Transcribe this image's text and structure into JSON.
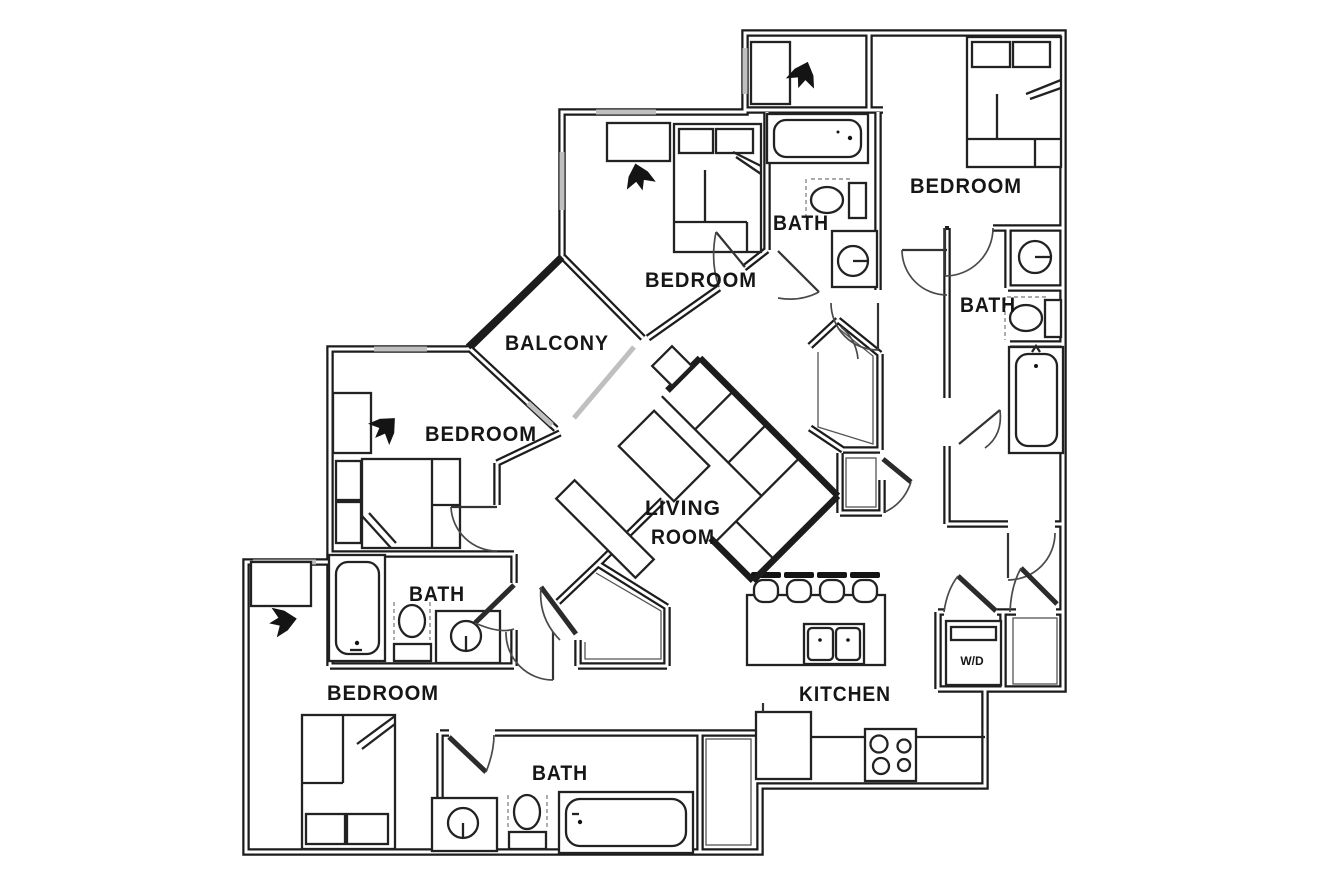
{
  "plan": {
    "colors": {
      "line": "#1c1c1c",
      "window": "#bfbfbf",
      "door_arc": "#4a4a4a"
    },
    "labels": {
      "bedroom_top_right": "BEDROOM",
      "bath_top_middle": "BATH",
      "bedroom_top_middle": "BEDROOM",
      "bath_right": "BATH",
      "balcony": "BALCONY",
      "bedroom_left": "BEDROOM",
      "living_line1": "LIVING",
      "living_line2": "ROOM",
      "bath_middle_left": "BATH",
      "bedroom_bottom_left": "BEDROOM",
      "bath_bottom": "BATH",
      "kitchen": "KITCHEN",
      "washer_dryer": "W/D"
    }
  }
}
